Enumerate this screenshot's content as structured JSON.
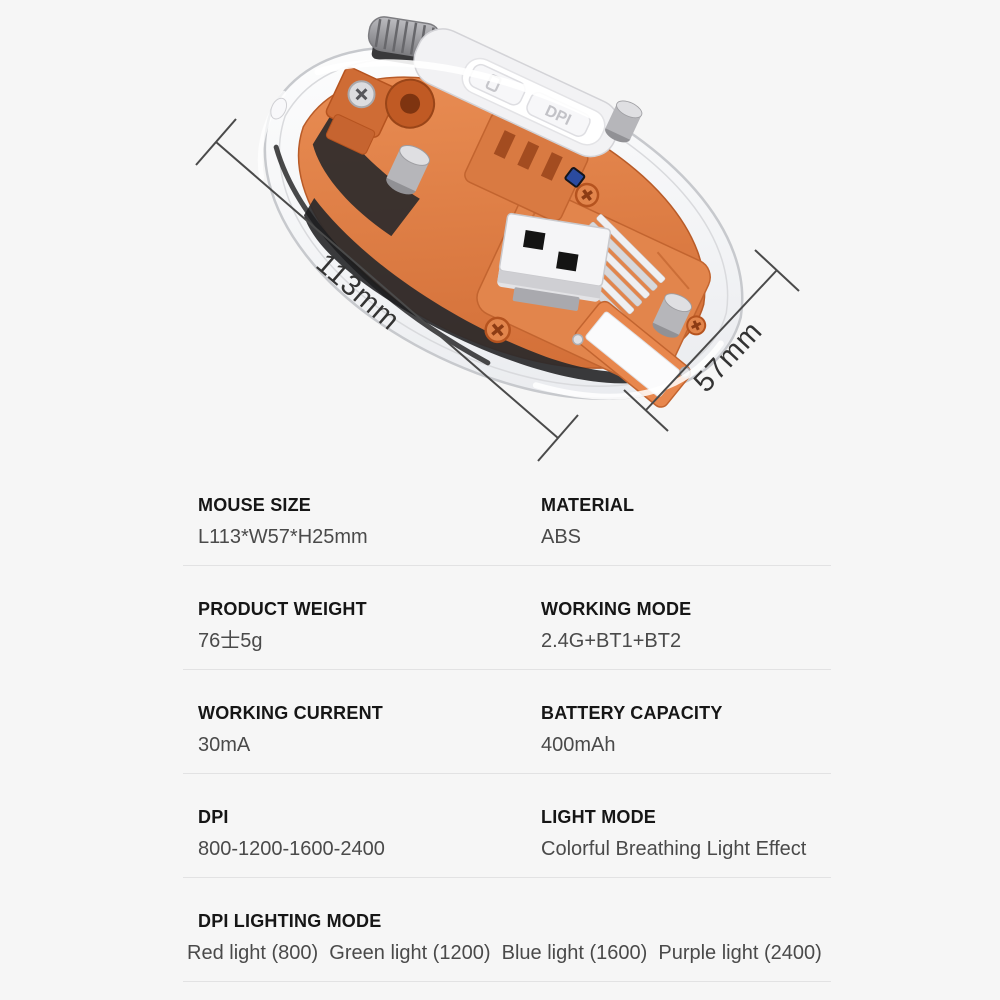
{
  "page": {
    "background": "#f6f6f6"
  },
  "diagram": {
    "length_label": "113mm",
    "width_label": "57mm",
    "dpi_button_label": "DPI",
    "colors": {
      "chassis_orange": "#df8049",
      "orange_outline": "#b5531f",
      "shell_gray": "#c7c9cd",
      "pcb_dark": "#29292b",
      "dimension_line": "#4a4a4a"
    }
  },
  "specs": {
    "rows": [
      {
        "cells": [
          {
            "label": "MOUSE SIZE",
            "value": "L113*W57*H25mm"
          },
          {
            "label": "MATERIAL",
            "value": "ABS"
          }
        ]
      },
      {
        "cells": [
          {
            "label": "PRODUCT WEIGHT",
            "value": "76士5g"
          },
          {
            "label": "WORKING MODE",
            "value": "2.4G+BT1+BT2"
          }
        ]
      },
      {
        "cells": [
          {
            "label": "WORKING CURRENT",
            "value": "30mA"
          },
          {
            "label": "BATTERY CAPACITY",
            "value": "400mAh"
          }
        ]
      },
      {
        "cells": [
          {
            "label": "DPI",
            "value": "800-1200-1600-2400"
          },
          {
            "label": "LIGHT MODE",
            "value": "Colorful Breathing Light Effect"
          }
        ]
      },
      {
        "cells": [
          {
            "label": "DPI LIGHTING MODE",
            "value": "Red light (800)  Green light (1200)  Blue light (1600)  Purple light (2400)"
          }
        ]
      }
    ]
  }
}
